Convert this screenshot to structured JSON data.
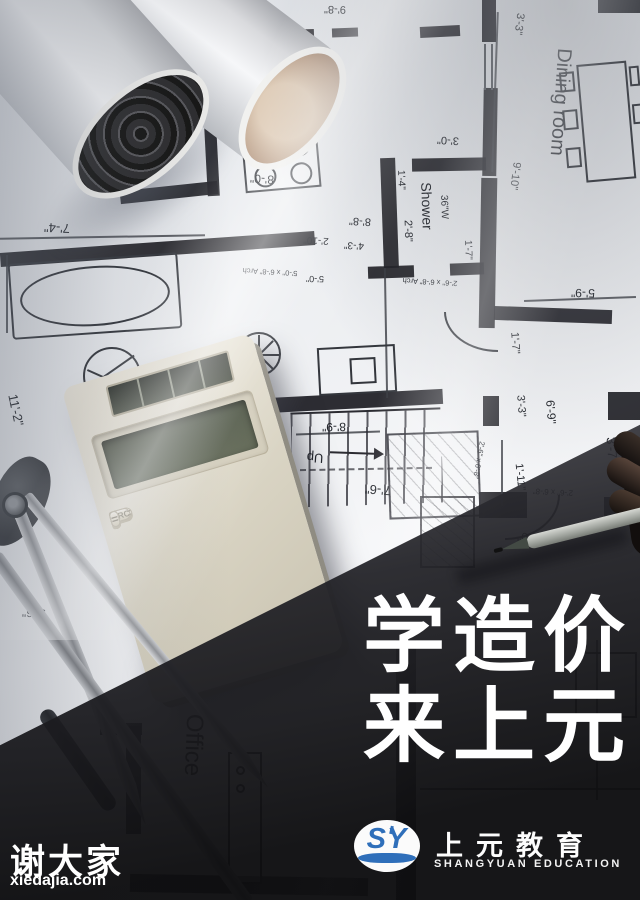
{
  "poster": {
    "headline": {
      "line1": "学造价",
      "line2": "来上元"
    },
    "logo": {
      "monogram": "SY",
      "name_cn": "上元教育",
      "name_en": "SHANGYUAN EDUCATION"
    },
    "watermark": {
      "name": "谢大家",
      "site": "xiedajia.com"
    }
  },
  "calculator": {
    "keys": [
      "OFF",
      "%",
      "√",
      "ON/C",
      "M+",
      "M−",
      "MRC",
      "÷",
      "7",
      "8",
      "9",
      "×",
      "4",
      "5",
      "6",
      "−",
      "1",
      "2",
      "3",
      "+",
      "0",
      ".",
      "="
    ]
  },
  "blueprint": {
    "rooms": [
      "Dining room",
      "Shower",
      "Office"
    ],
    "dimensions": [
      "7'-4\"",
      "9'-8\"",
      "8'-0\"",
      "3'-0\"",
      "3'-3\"",
      "9'-10\"",
      "1'-4\"",
      "2'-8\"",
      "8'-8\"",
      "4'-3\"",
      "2'-10\"",
      "5'-0\"",
      "11'-2\"",
      "8'-9\"",
      "7'-6\"",
      "5'-9\"",
      "1'-7\"",
      "3'-3\"",
      "6'-9\"",
      "1'-11\"",
      "3'-7\"",
      "2'-0\"",
      "9'-6\"",
      "1'-7\""
    ],
    "arch_notes": [
      "5'-0\" x 6'-8\" Arch",
      "2'-6\" x 6'-8\" Arch",
      "2'-6\" x 6'-8\"",
      "2'-6\" x 6'-8\""
    ],
    "stairs_label": "Up",
    "shower_note": "36\"W"
  },
  "colors": {
    "logo_blue": "#2f6fba",
    "overlay_dark": "#1d1d20",
    "paper": "#e9ebee",
    "wall_ink": "#212126"
  }
}
